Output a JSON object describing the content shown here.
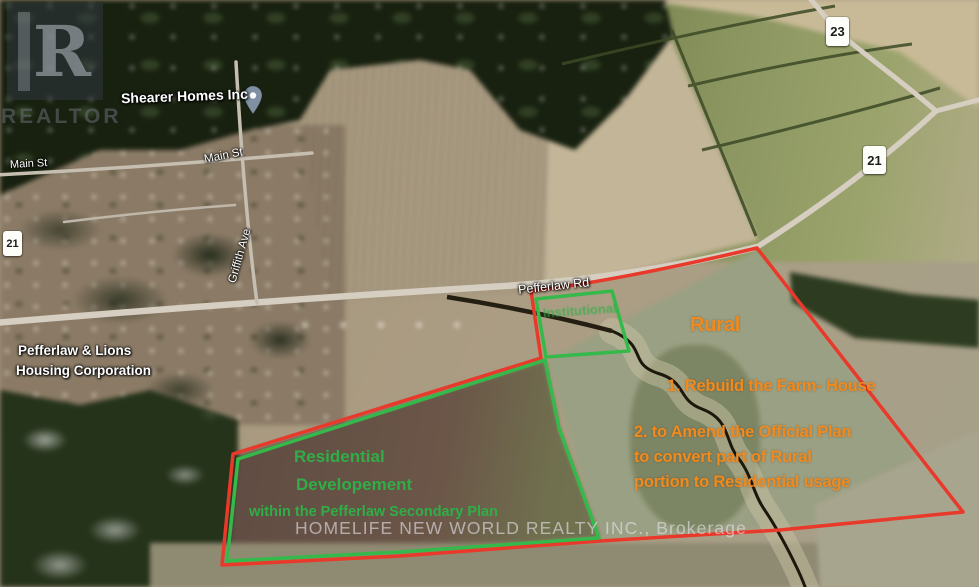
{
  "map": {
    "watermark_logo": {
      "letter": "R",
      "label": "REALTOR"
    },
    "brokerage_watermark": "HOMELIFE NEW WORLD REALTY INC., Brokerage",
    "place_labels": {
      "business": "Shearer Homes Inc",
      "main_st_left": "Main St",
      "main_st_top": "Main St",
      "griffith_ave": "Griffith Ave",
      "housing_corp_line1": "Pefferlaw & Lions",
      "housing_corp_line2": "Housing Corporation",
      "pefferlaw_rd": "Pefferlaw Rd"
    },
    "road_badges": {
      "left": "21",
      "top": "23",
      "right": "21"
    },
    "annotations": {
      "rural": "Rural",
      "note1": "1. Rebuild the Farm- House",
      "note2_line1": "2. to Amend the Official Plan",
      "note2_line2": "to convert part of Rural",
      "note2_line3": "portion to Residential usage",
      "residential_line1": "Residential",
      "residential_line2": "Developement",
      "residential_line3": "within the Pefferlaw Secondary Plan",
      "parcel_label": "Institutional"
    },
    "colors": {
      "boundary_red": "#e8392b",
      "boundary_green": "#35b94a",
      "annotation_orange": "#f08a1e",
      "annotation_green": "#2fae47"
    }
  }
}
